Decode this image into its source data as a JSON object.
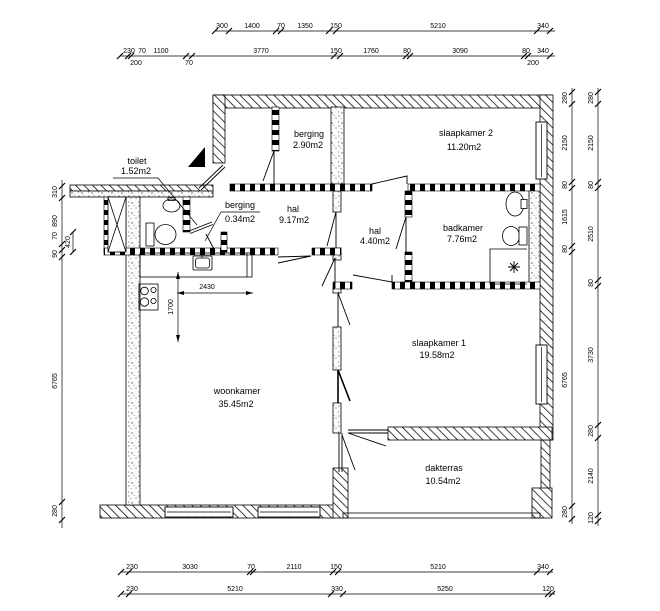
{
  "drawing": {
    "kind": "floor plan",
    "colors": {
      "ink": "#000000",
      "paper": "#ffffff"
    }
  },
  "rooms": {
    "toilet": {
      "name": "toilet",
      "area": "1.52m2"
    },
    "berging_small": {
      "name": "berging",
      "area": "0.34m2"
    },
    "berging": {
      "name": "berging",
      "area": "2.90m2"
    },
    "slaapkamer2": {
      "name": "slaapkamer 2",
      "area": "11.20m2"
    },
    "hal": {
      "name": "hal",
      "area": "9.17m2"
    },
    "hal2": {
      "name": "hal",
      "area": "4.40m2"
    },
    "badkamer": {
      "name": "badkamer",
      "area": "7.76m2"
    },
    "woonkamer": {
      "name": "woonkamer",
      "area": "35.45m2"
    },
    "slaapkamer1": {
      "name": "slaapkamer 1",
      "area": "19.58m2"
    },
    "dakterras": {
      "name": "dakterras",
      "area": "10.54m2"
    }
  },
  "dimensions": {
    "top_row1": [
      "300",
      "1400",
      "70",
      "1350",
      "150",
      "5210",
      "340"
    ],
    "top_row2": [
      "230",
      "70",
      "1100",
      "3770",
      "150",
      "1760",
      "80",
      "3090",
      "80",
      "340"
    ],
    "top_row2_sub": [
      "200",
      "70",
      "200"
    ],
    "bottom_row1": [
      "230",
      "3030",
      "70",
      "2110",
      "150",
      "5210",
      "340"
    ],
    "bottom_row2": [
      "230",
      "5210",
      "330",
      "5250",
      "120"
    ],
    "left": [
      "310",
      "890",
      "70",
      "90",
      "6765",
      "280"
    ],
    "left_sub": [
      "420"
    ],
    "right_inner": [
      "280",
      "2150",
      "80",
      "1615",
      "80",
      "6765",
      "280"
    ],
    "right_outer": [
      "280",
      "2150",
      "80",
      "2510",
      "80",
      "3730",
      "280",
      "2140",
      "120"
    ],
    "kitchen": [
      "2430",
      "1700"
    ]
  }
}
